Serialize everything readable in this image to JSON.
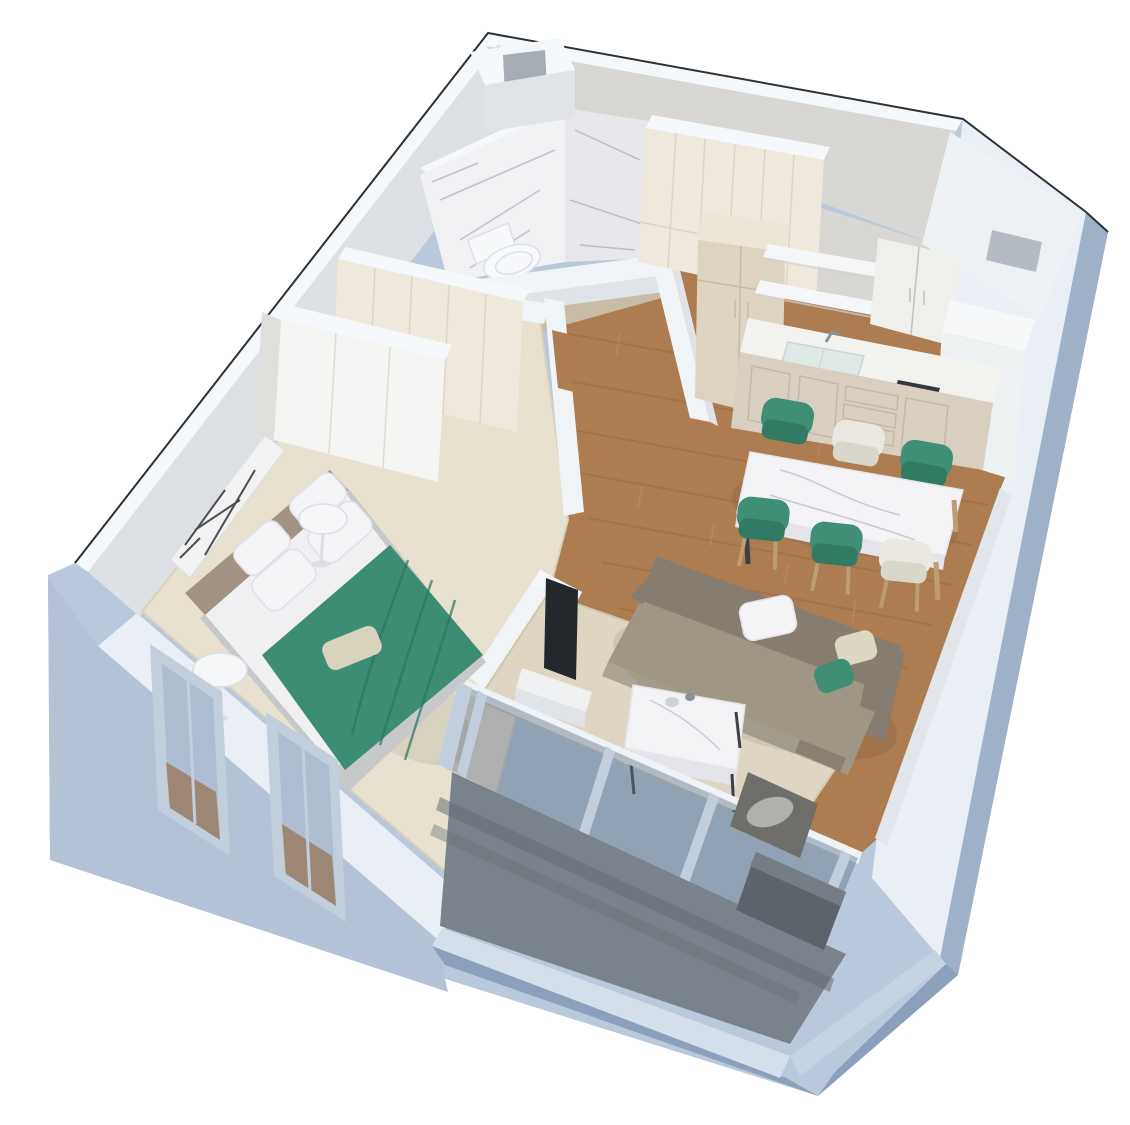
{
  "scene": {
    "type": "isometric-3d-floor-plan-render",
    "style": "cutaway apartment visualization, one-bedroom unit",
    "view": "top-down oblique from south-west",
    "background": "#ffffff"
  },
  "rooms": [
    {
      "name": "Bathroom",
      "position": "top-left",
      "floor": "beige tile",
      "walls": "white marble with gray veins",
      "furniture": [
        "toilet",
        "duct shaft niche"
      ]
    },
    {
      "name": "Hallway",
      "position": "center-top",
      "floor": "wood parquet",
      "furniture": [
        "built-in cream wardrobe"
      ]
    },
    {
      "name": "Kitchen",
      "position": "top-right",
      "floor": "wood parquet",
      "furniture": [
        "tall beige cabinet",
        "two floating shelves",
        "upper two-door cabinet",
        "white counter with sink",
        "gas hob",
        "tall white fridge volume",
        "wall niche"
      ]
    },
    {
      "name": "Dining area",
      "position": "right",
      "floor": "wood parquet",
      "furniture": [
        "white marble dining table",
        "4 teal upholstered chairs",
        "2 cream chairs"
      ]
    },
    {
      "name": "Living room",
      "position": "center-bottom-right",
      "floor": "wood parquet with cream rug",
      "furniture": [
        "greige corner sofa",
        "white pillow",
        "beige pillow",
        "teal pillow",
        "marble coffee table on metal frame",
        "flat TV",
        "white TV stand"
      ]
    },
    {
      "name": "Bedroom",
      "position": "left",
      "floor": "cream carpet",
      "furniture": [
        "double bed with taupe headboard",
        "white pillows",
        "green throw blanket",
        "beige accent pillow",
        "2 round white side tables",
        "2 built-in wardrobes",
        "black-and-white abstract wall art"
      ]
    },
    {
      "name": "Balcony",
      "position": "bottom",
      "floor": "dark gray decking with steps",
      "furniture": [
        "glass railing with frames",
        "dark armchair",
        "dark lounge seat"
      ]
    }
  ],
  "palette": {
    "background": "#ffffff",
    "outline": "#2e3134",
    "extBase": "#b9c8da",
    "extWest": "#b3c2d5",
    "extEast": "#9eb1c7",
    "extParapetDark": "#8ba0ba",
    "bandWhite": "#e9eff5",
    "bandBright": "#f4f8fb",
    "parapetBandLight": "#d5dfeb",
    "parapetBandMid": "#c5d2e1",
    "innerNW": "#dde1e5",
    "innerNE": "#d8d7d3",
    "innerEastStrip": "#e2e6ea",
    "partition": "#f1f4f6",
    "partitionFace": "#e0e4e8",
    "wood": "#ad7c50",
    "woodDark": "#8f6238",
    "woodLight": "#c2915e",
    "carpet": "#e8e1cf",
    "carpetEdge": "#d9d1bc",
    "rug": "#ded6c3",
    "rugEdge": "#cfc7b2",
    "bathFloor": "#c8bca6",
    "balconyFloor": "#7a828b",
    "balconyFloorDark": "#666d76",
    "marble": "#f1f1f4",
    "marbleShade": "#e7e7ec",
    "marbleVein": "#a3a3b0",
    "wardrobeCream": "#efe8dd",
    "wardrobeWhite": "#f4f4f3",
    "wardrobeSide": "#e0dfdc",
    "seam": "#d8d0c2",
    "tallCabinet": "#ddd3c1",
    "tallCabinetTop": "#ece5d8",
    "counterTop": "#f2f2ee",
    "cabinetFront": "#d8cfc0",
    "cabinetLine": "#bfb5a3",
    "shelf": "#f4f6f7",
    "shelfShadow": "#cfd4d8",
    "upperCab": "#efefec",
    "fridge": "#f5f7f8",
    "fridgeFace": "#eef1f2",
    "nicheRecess": "#b4bbc2",
    "nicheReveal": "#edf1f4",
    "cornerVolume": "#eef1f4",
    "ductRecess": "#a6acb3",
    "sinkGlass": "#dfe9e6",
    "hob": "#33383e",
    "hobBurner": "#5a6168",
    "faucet": "#8c9299",
    "tableMarble": "#f3f3f6",
    "tableEdge": "#e4e4ea",
    "legDark": "#3f4045",
    "legWood": "#bd9e74",
    "chairTeal": "#3f8e76",
    "chairTealDark": "#317b65",
    "chairWhite": "#eae8e1",
    "chairWhiteDark": "#d9d6cc",
    "sofaBack": "#867d70",
    "sofaSeat": "#a09685",
    "sofaDark": "#6f675c",
    "pillowWhite": "#f4f4f6",
    "pillowEdge": "#e0e0e6",
    "pillowBeige": "#ddd6c2",
    "tvBlack": "#23282d",
    "tvStand": "#eef0f1",
    "bedBase": "#c6c8ca",
    "mattress": "#f0f0f2",
    "headboard": "#a39384",
    "throwGreen": "#3c8d74",
    "throwGreenDark": "#2c7560",
    "accentPillow": "#d9d2bd",
    "sideTable": "#f5f6f7",
    "sideTableStroke": "#dcdfe2",
    "artLight": "#f2f2f3",
    "artDark": "#303036",
    "glassTint": "#5a6d80",
    "glassFrame": "#c2cedc",
    "railWhite": "#eef3f8",
    "toilet": "#f7f8f9",
    "toiletShade": "#dce0e3",
    "armchair": "#6e6e6a",
    "armchairCushion": "#b2b0aa",
    "loungeDark": "#5d636a",
    "loungeTop": "#777d84",
    "shadow": "#000000"
  }
}
